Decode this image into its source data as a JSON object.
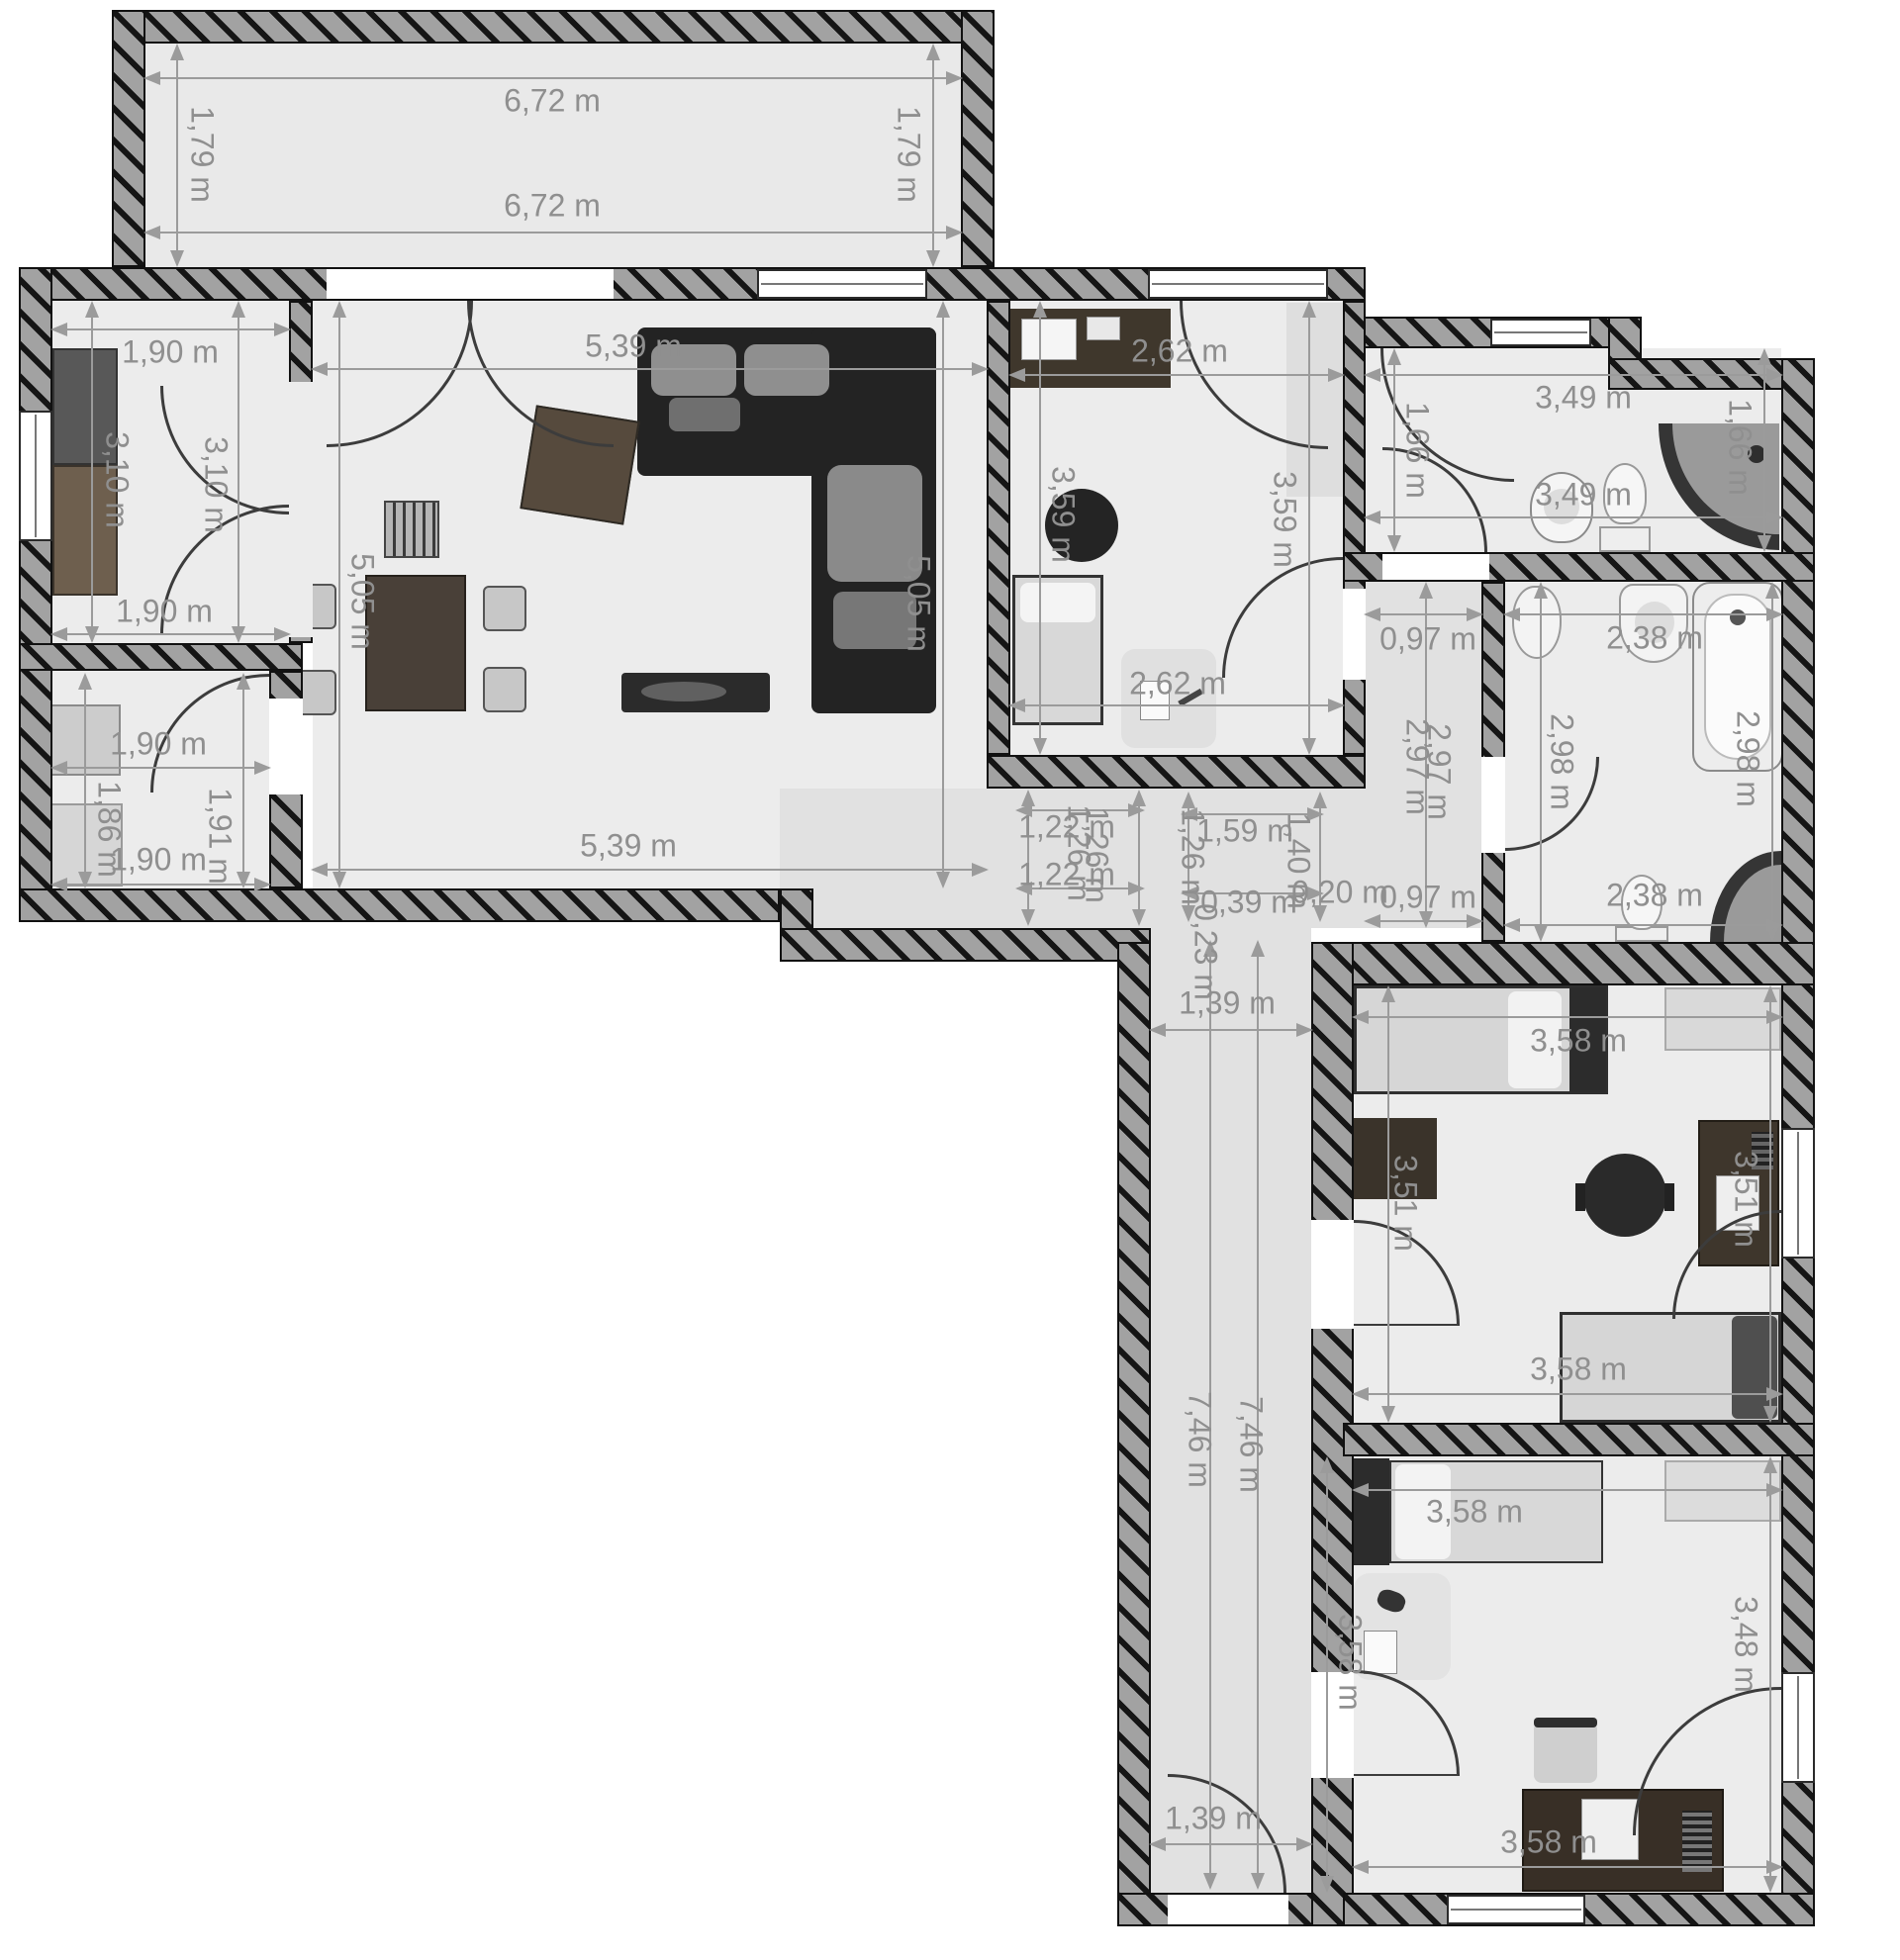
{
  "plan_title": "apartment-floor-plan",
  "unit": "m",
  "colors": {
    "wall_fill": "#a2a2a2",
    "wall_stripe": "#151515",
    "room_floor": "#ececec",
    "corridor_floor": "#e1e1e1",
    "balcony_floor": "#e9e9e9",
    "dimension_text": "#8f8f8f",
    "dimension_line": "#9b9b9b",
    "sofa_dark": "#232323",
    "wood_dark": "#4a4036"
  },
  "dims": {
    "balcony": [
      "6,72 m",
      "1,79 m",
      "1,79 m",
      "6,72 m"
    ],
    "kitchen": [
      "1,90 m",
      "3,10 m",
      "3,10 m",
      "1,90 m"
    ],
    "storage": [
      "1,90 m",
      "1,86 m",
      "1,91 m",
      "1,90 m"
    ],
    "living": [
      "5,39 m",
      "5,05 m",
      "5,05 m",
      "5,39 m"
    ],
    "bedroom1": [
      "2,62 m",
      "3,59 m",
      "3,59 m",
      "2,62 m"
    ],
    "wc": [
      "3,49 m",
      "1,66 m",
      "1,66 m",
      "3,49 m"
    ],
    "corridor_upper": [
      "0,97 m",
      "2,97 m",
      "2,97 m",
      "0,97 m"
    ],
    "bathroom": [
      "2,38 m",
      "2,98 m",
      "2,98 m",
      "2,38 m"
    ],
    "hall": [
      "1,22 m",
      "1,26 m",
      "1,26 m",
      "1,22 m",
      "1,59 m",
      "1,26 m",
      "1,40 m",
      "0,39 m",
      "0,20 m",
      "0,23 m"
    ],
    "corridor": [
      "1,39 m",
      "7,46 m",
      "7,46 m",
      "1,39 m"
    ],
    "bedroom2": [
      "3,58 m",
      "3,51 m",
      "3,51 m",
      "3,58 m"
    ],
    "bedroom3": [
      "3,58 m",
      "3,58 m",
      "3,48 m",
      "3,58 m"
    ]
  }
}
